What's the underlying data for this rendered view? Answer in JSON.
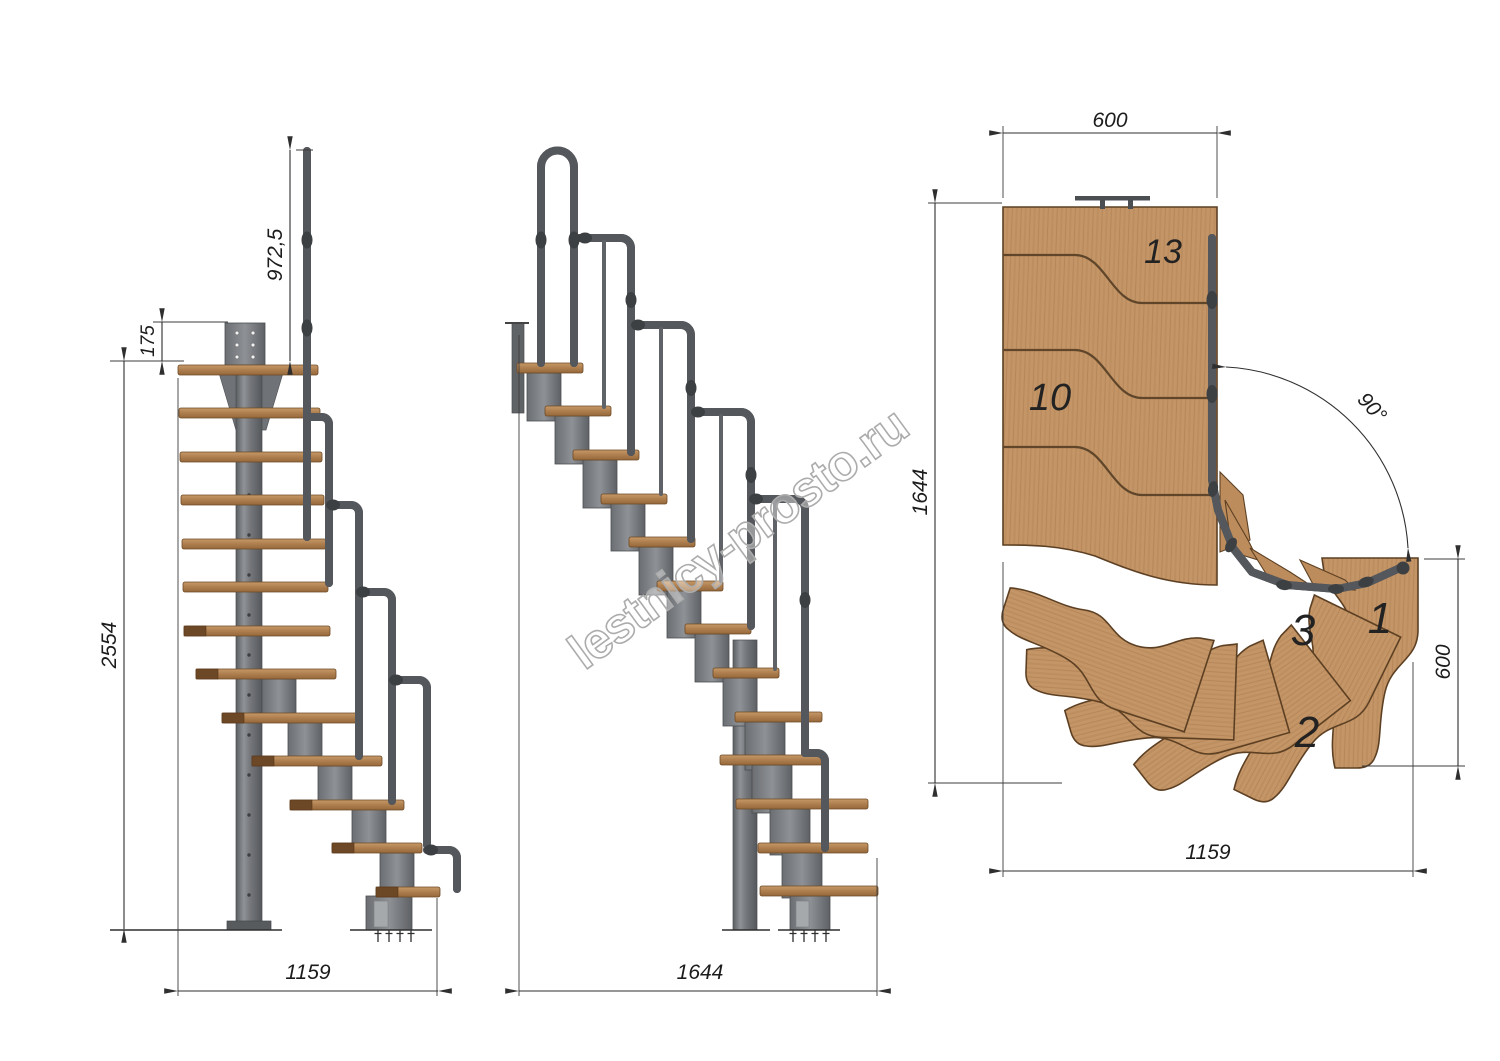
{
  "watermark": {
    "text": "lestnicy-prosto.ru"
  },
  "views": {
    "front": {
      "name": "front-elevation",
      "dims": {
        "total_height": "2554",
        "top_offset": "175",
        "handrail_height": "972,5",
        "width": "1159"
      }
    },
    "side": {
      "name": "side-elevation",
      "dims": {
        "length": "1644"
      }
    },
    "plan": {
      "name": "plan-view",
      "dims": {
        "top_width": "600",
        "depth": "1644",
        "exit_width": "600",
        "bottom_width": "1159",
        "turn_angle": "90°"
      },
      "tread_labels": {
        "top": "13",
        "middle": "10",
        "third": "3",
        "first": "1",
        "second": "2"
      }
    }
  },
  "colors": {
    "background": "#ffffff",
    "wood": "#c49566",
    "wood_outline": "#5d4023",
    "steel": "#777a7e",
    "dimension": "#2f2f2f"
  }
}
